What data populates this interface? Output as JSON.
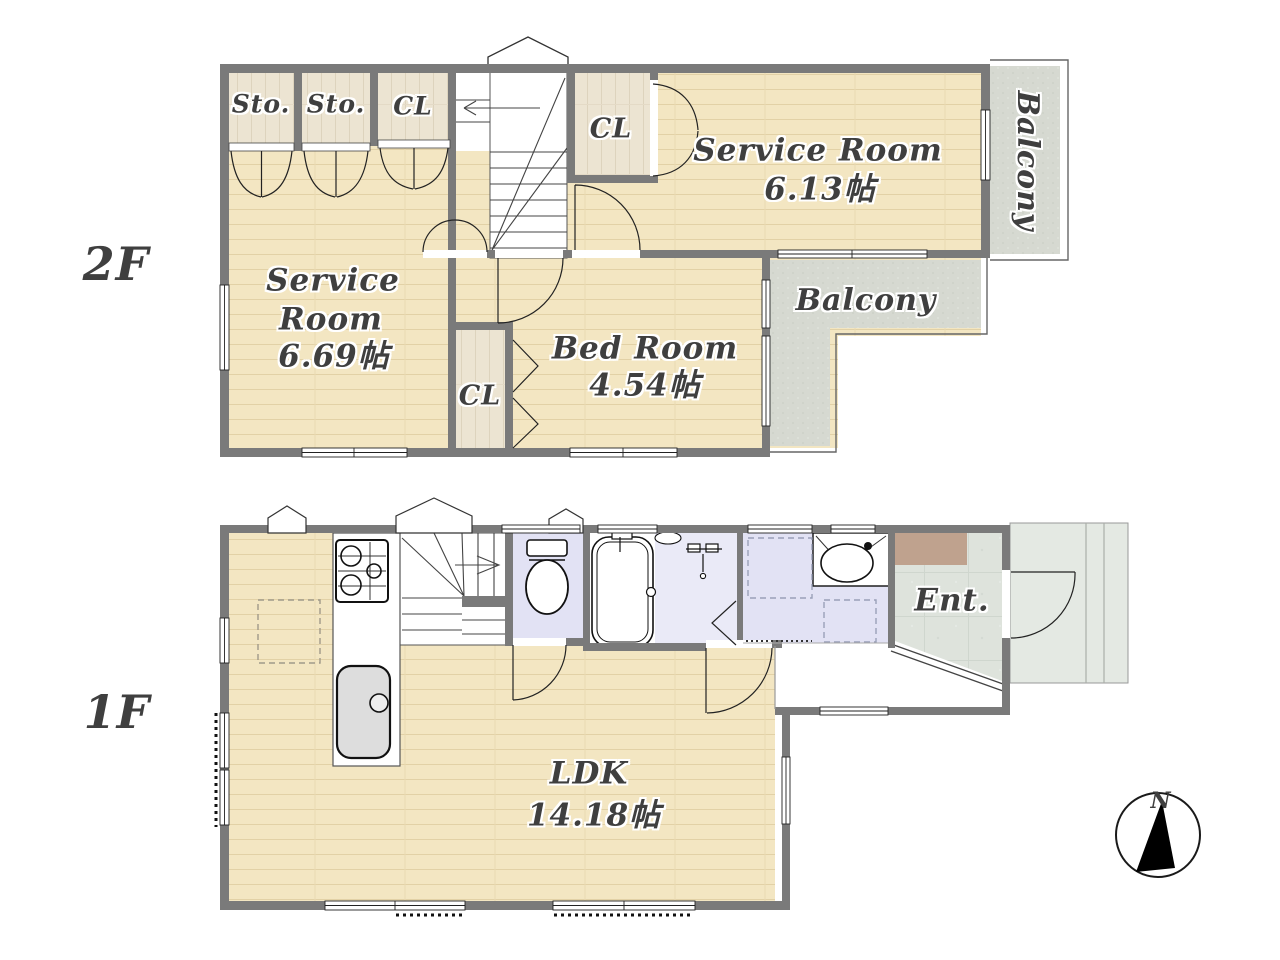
{
  "floor2": {
    "floor_label": "2F",
    "storage1": "Sto.",
    "storage2": "Sto.",
    "closet_top": "CL",
    "closet_right": "CL",
    "service_room_a_name": "Service Room",
    "service_room_a_size": "6.13帖",
    "balcony_right": "Balcony",
    "service_room_b_line1": "Service",
    "service_room_b_line2": "Room",
    "service_room_b_size": "6.69帖",
    "closet_mid": "CL",
    "bed_room_name": "Bed Room",
    "bed_room_size": "4.54帖",
    "balcony_l": "Balcony"
  },
  "floor1": {
    "floor_label": "1F",
    "entrance": "Ent.",
    "ldk_name": "LDK",
    "ldk_size": "14.18帖"
  },
  "compass": {
    "north": "N"
  },
  "colors": {
    "wall": "#7a7a7a",
    "wood_floor": "#f3e6c2",
    "closet_floor": "#ece4d2",
    "balcony_floor": "#d7dad2",
    "tile_floor": "#dfe4dd",
    "wet_room_floor": "#e2e2f4",
    "shoe_cabinet": "#bfa28e",
    "label_text": "#3f3f3f"
  }
}
